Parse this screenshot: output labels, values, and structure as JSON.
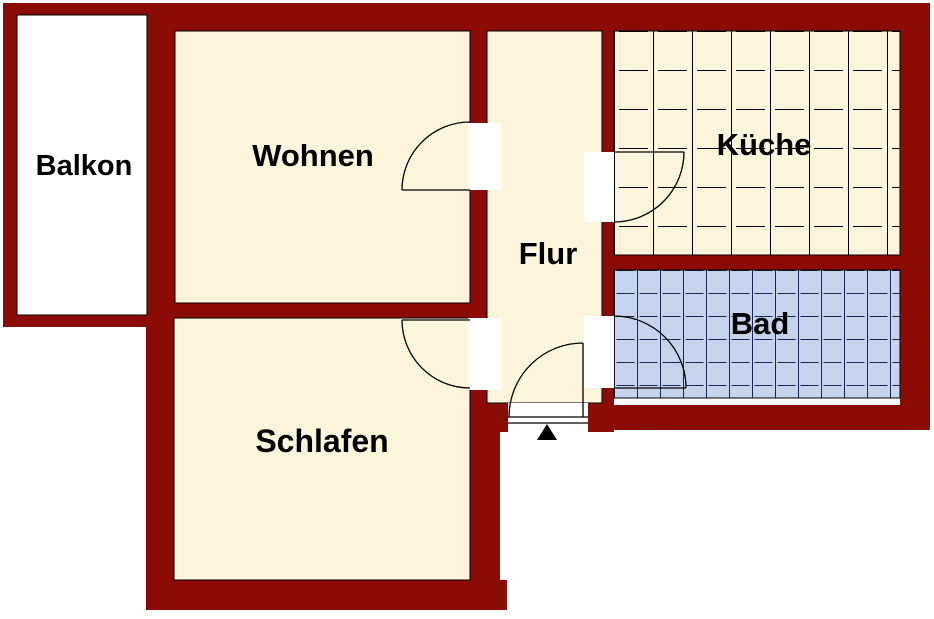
{
  "rooms": {
    "balkon": {
      "label": "Balkon"
    },
    "wohnen": {
      "label": "Wohnen"
    },
    "flur": {
      "label": "Flur"
    },
    "kueche": {
      "label": "Küche"
    },
    "bad": {
      "label": "Bad"
    },
    "schlafen": {
      "label": "Schlafen"
    }
  },
  "colors": {
    "wall": "#8B0B06",
    "outline": "#000000",
    "room_fill": "#FDF4DC",
    "balkon_fill": "#FFFFFF",
    "bad_fill": "#C5D3EC",
    "bad_grid": "#17255A",
    "kueche_grid": "#000000",
    "door_arc": "#000000",
    "entrance_marker": "#000000",
    "label_color": "#000000",
    "background": "#FFFFFF"
  }
}
